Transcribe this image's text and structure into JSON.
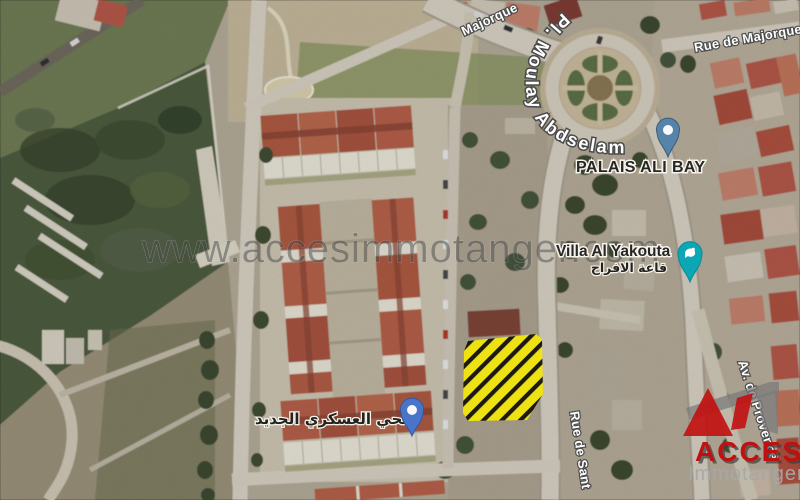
{
  "map": {
    "watermark": "www.accesimmotanger.com",
    "streets": {
      "majorque_partial": "Majorque",
      "pl_moulay_abdselam": "Pl. Moulay Abdselam",
      "rue_de_majorque": "Rue de Majorque",
      "rue_de_sant": "Rue de Sant",
      "av_de_provence": "Av. de Provence"
    },
    "places": {
      "palais_ali_bay": "PALAIS ALI BAY",
      "villa_al_yakouta": "Villa Al Yakouta",
      "villa_al_yakouta_arabic": "قاعة الافراح",
      "military_district_arabic": "الحي العسكري الجديد"
    },
    "highlight": {
      "fill": "#f1e40e",
      "stripes": "#18150d"
    },
    "pins": {
      "palais_pin_color": "#5583a9",
      "villa_pin_color": "#0ba7b5",
      "district_pin_color": "#4a74c9"
    },
    "logo": {
      "brand": "ACCES",
      "subtitle": "Immotanger",
      "brand_color": "#c11010",
      "mark_gray": "#7a7a7a"
    }
  }
}
